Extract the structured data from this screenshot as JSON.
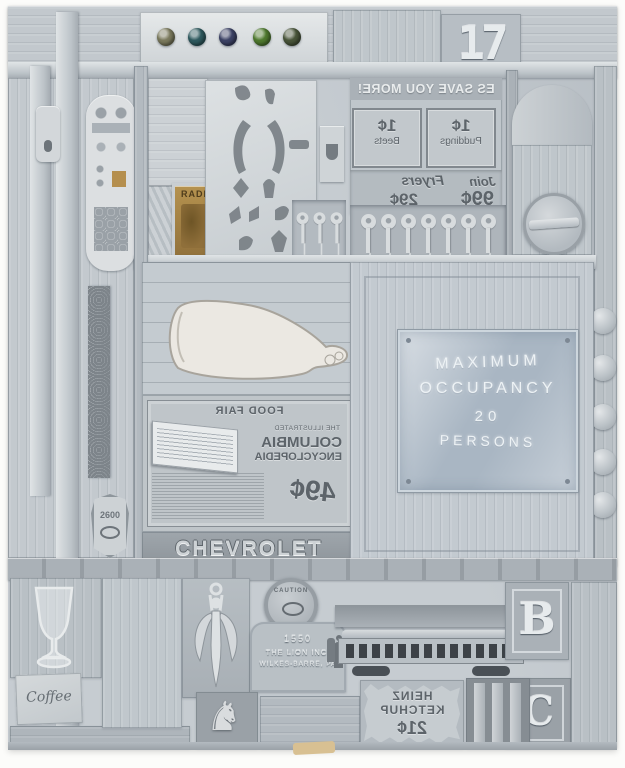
{
  "photo": {
    "background": "#fcfcfa"
  },
  "artwork": {
    "palette": {
      "base": "#c6ccd1",
      "light": "#e2e5e7",
      "mid": "#aab1b7",
      "dark": "#8b9298",
      "sign_blue": "#a9b6c3",
      "tin_gold": "#ab8a4d",
      "plaster": "#ece9e3",
      "chip_tan": "#d8c092"
    },
    "top_section": {
      "number": "17",
      "marbles": {
        "count": 5,
        "colors": [
          "#7b7a5d",
          "#2f5a5f",
          "#3d4366",
          "#4f7a2f",
          "#49553a"
        ]
      }
    },
    "left_column": {
      "badge_number": "2600"
    },
    "grocery_plate": {
      "mirrored": true,
      "headline": "ES SAVE YOU MORE!",
      "boxes": [
        {
          "item": "Puddings",
          "price": "1¢"
        },
        {
          "item": "Beets",
          "price": "1¢"
        }
      ],
      "line1": "Join",
      "line2": "Fryers",
      "price_big": "99¢",
      "price_small": "29¢"
    },
    "radio_tin": {
      "label": "RADIO"
    },
    "keys": {
      "small_count": 3,
      "row_count": 7
    },
    "knobs_count": 5,
    "occupancy_sign": {
      "lines": [
        "MAXIMUM",
        "OCCUPANCY",
        "20",
        "PERSONS"
      ]
    },
    "encyclopedia_ad": {
      "mirrored": true,
      "header": "FOOD FAIR",
      "title_small": "THE ILLUSTRATED",
      "title_main": "COLUMBIA",
      "title_sub": "ENCYCLOPEDIA",
      "price": "49¢"
    },
    "chevrolet_label": "CHEVROLET",
    "bottom_section": {
      "caution_label": "CAUTION",
      "plaque": {
        "line1": "1550",
        "line2": "THE LION INC.",
        "line3": "WILKES-BARRE, PA"
      },
      "letter_b": "B",
      "letter_c": "C",
      "coffee_label": "Coffee",
      "heinz_sign": {
        "mirrored": true,
        "line1": "HEINZ",
        "line2": "KETCHUP",
        "price": "21¢"
      }
    }
  }
}
